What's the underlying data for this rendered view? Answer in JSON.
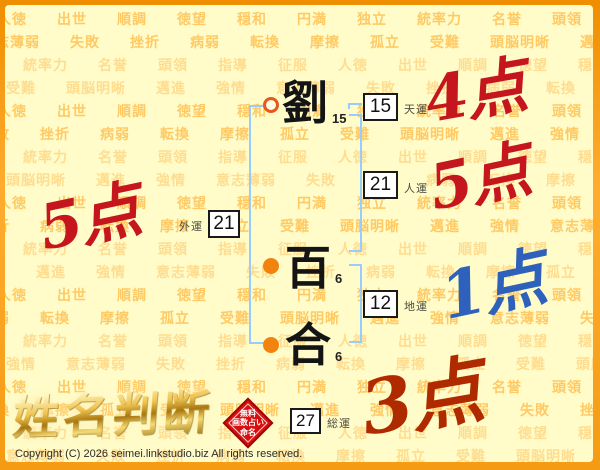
{
  "watermark": {
    "positive_words": [
      "人徳",
      "出世",
      "順調",
      "徳望",
      "穏和",
      "円満",
      "独立",
      "統率力",
      "名誉",
      "頭領",
      "指導",
      "征服"
    ],
    "negative_words": [
      "意志薄弱",
      "失敗",
      "挫折",
      "病弱",
      "転換",
      "摩擦",
      "孤立",
      "受難",
      "頭脳明晰",
      "邁進",
      "強情"
    ]
  },
  "name": {
    "chars": [
      {
        "glyph": "劉",
        "strokes": "15"
      },
      {
        "glyph": "百",
        "strokes": "6"
      },
      {
        "glyph": "合",
        "strokes": "6"
      }
    ]
  },
  "fortunes": {
    "tenun": {
      "label": "天運",
      "value": "15",
      "score": "4点"
    },
    "jinun": {
      "label": "人運",
      "value": "21",
      "score": "5点"
    },
    "gaiun": {
      "label": "外運",
      "value": "21",
      "score": "5点"
    },
    "chiun": {
      "label": "地運",
      "value": "12",
      "score": "1点"
    },
    "soun": {
      "label": "総運",
      "value": "27",
      "score": "3点"
    }
  },
  "branding": {
    "logo": "姓名判断",
    "seal": [
      "無料",
      "画数占い",
      "命名"
    ],
    "copyright": "Copyright (C) 2026 seimei.linkstudio.biz All rights reserved."
  },
  "colors": {
    "frame": "#F59B13",
    "background": "#FFFCC9",
    "watermark": "#FFC255",
    "watermark_light": "#FFDC8E",
    "bracket_blue": "#99CCFE",
    "marker_orange": "#F2830F",
    "score_red": "#C5161D",
    "score_blue": "#2E61BC",
    "score_dark_red": "#B02A00",
    "seal_red": "#D80D0D",
    "gold": "#E7B53A"
  }
}
